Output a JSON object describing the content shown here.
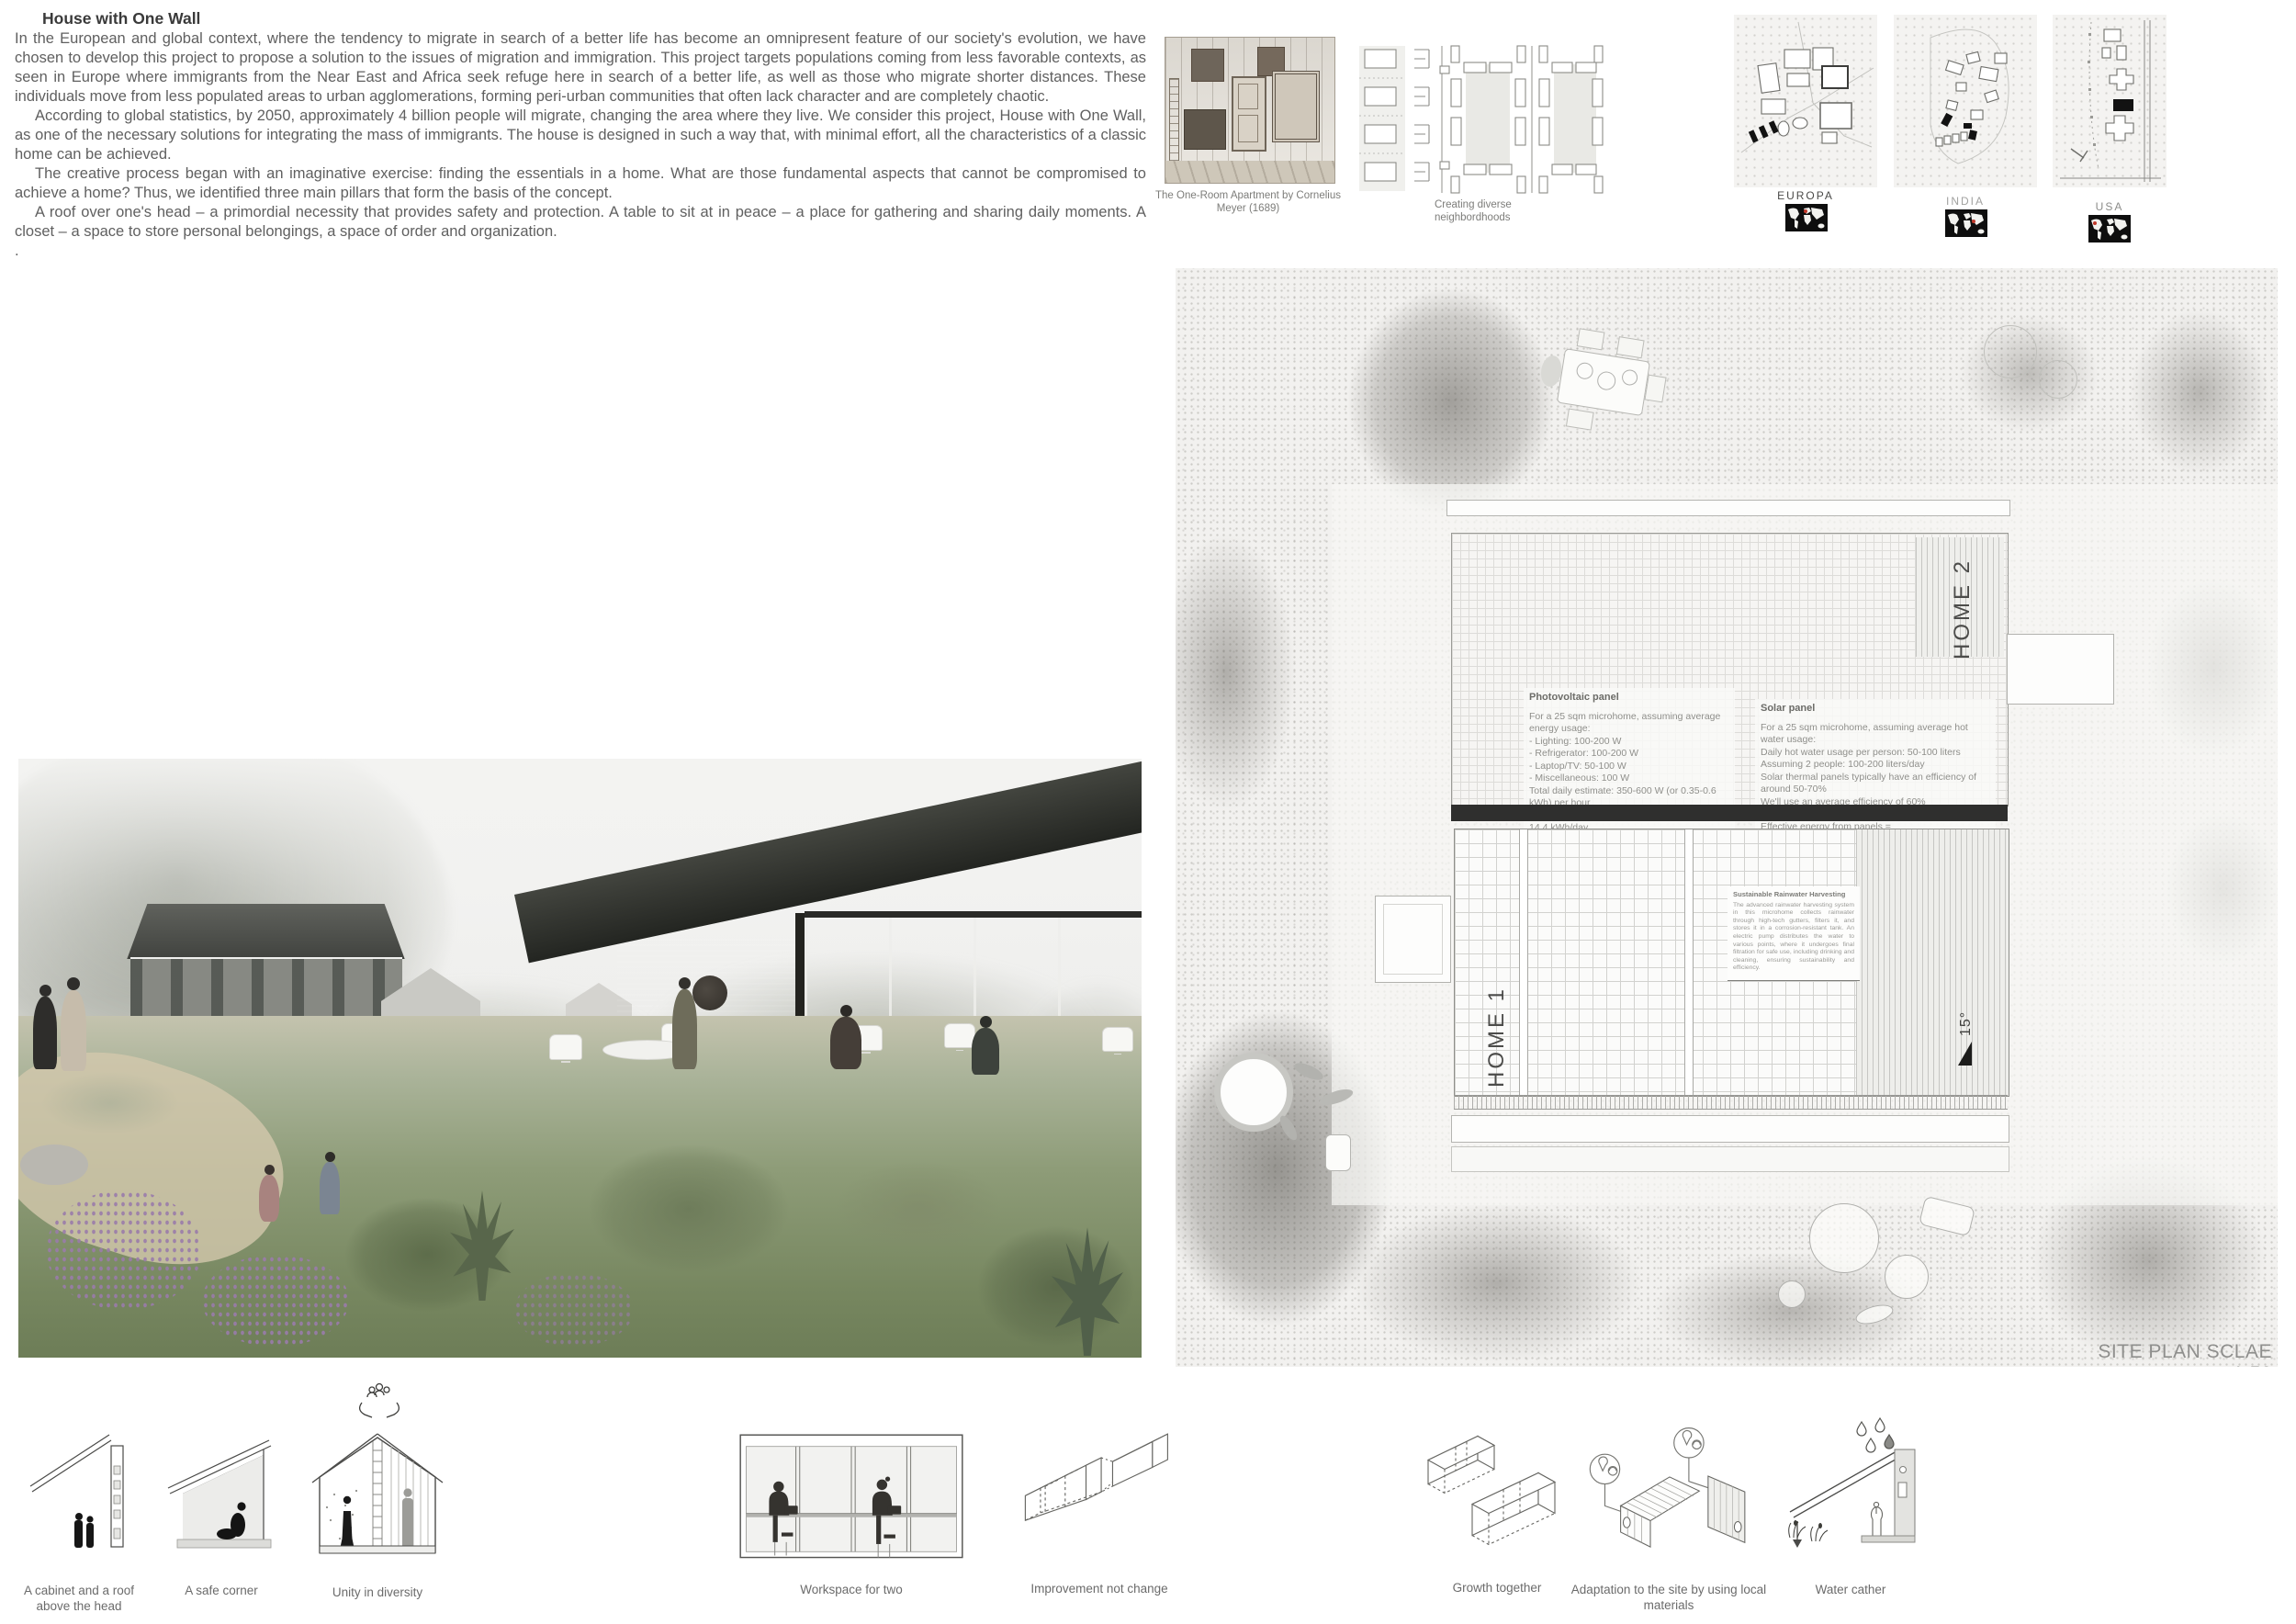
{
  "colors": {
    "map_marker_red": "#c0392b",
    "one_wall_black": "#2f2f2e",
    "text_gray": "#606060"
  },
  "icons": {
    "hands_people": "hands-holding-community",
    "location_material": "map-pin-with-leaf-cycle",
    "rain_drops": "water-droplets",
    "world_map": "black-world-map-with-red-marker"
  },
  "intro": {
    "title": "House with One Wall",
    "p1": "In the European and global context, where the tendency to migrate in search of a better life has become an omnipresent feature of our society's evolution, we have chosen to develop this project to propose a solution to the issues of migration and immigration. This project targets populations coming from less favorable contexts, as seen in Europe where immigrants from the Near East and Africa seek refuge here in search of a better life, as well as those who migrate shorter distances. These individuals move from less populated areas to urban agglomerations, forming peri-urban communities that often lack character and are completely chaotic.",
    "p2": "According to global statistics, by 2050, approximately 4 billion people will migrate, changing the area where they live. We consider this project, House with One Wall, as one of the necessary solutions for integrating the mass of immigrants. The house is designed in such a way that, with minimal effort, all the characteristics of a classic home can be achieved.",
    "p3": "The creative process began with an imaginative exercise: finding the essentials in a home. What are those fundamental aspects that cannot be compromised to achieve a home? Thus, we identified three main pillars that form the basis of the concept.",
    "p4": "A roof over one's head – a primordial necessity that provides safety and protection. A table to sit at in peace – a place for gathering and sharing daily moments. A closet – a space to store personal belongings, a space of order and organization.",
    "dot": "."
  },
  "references": {
    "etching_caption": "The One-Room Apartment by Cornelius Meyer (1689)",
    "neighborhoods_caption": "Creating diverse neighbordhoods"
  },
  "maps": [
    {
      "label": "EUROPA"
    },
    {
      "label": "INDIA"
    },
    {
      "label": "USA"
    }
  ],
  "site_plan": {
    "home1": "HOME 1",
    "home2": "HOME 2",
    "slope": "15°",
    "scale": "SITE PLAN SCLAE 1:50",
    "photovoltaic": {
      "title": "Photovoltaic panel",
      "lines": [
        "For a 25 sqm microhome, assuming average energy usage:",
        "- Lighting: 100-200 W",
        "- Refrigerator: 100-200 W",
        "- Laptop/TV: 50-100 W",
        "- Miscellaneous: 100 W",
        "Total daily estimate: 350-600 W (or 0.35-0.6 kWh) per hour",
        "For a full day: 350-600 W x 24 hours = 8.4 - 14.4 kWh/day",
        "1 sqm of solar panel produces = 0.15 kW x 4 hours = 0.6 kWh/day",
        "8.4 kWh / 0.6 kWh/sqm = 14 sqm"
      ]
    },
    "solar": {
      "title": "Solar panel",
      "lines": [
        "For a 25 sqm microhome, assuming average hot water usage:",
        "Daily hot water usage per person: 50-100 liters",
        "Assuming 2 people: 100-200 liters/day",
        "Solar thermal panels typically have an efficiency of around 50-70%",
        "We'll use an average efficiency of 60%",
        "For 100 liters (4.64 kWh/day):",
        "Effective energy from panels = 4.64/0.6=7.73kWh/day",
        "7.73kWh / 0.6 = 12.88 sqm"
      ]
    },
    "rainwater": {
      "title": "Sustainable Rainwater Harvesting",
      "body": "The advanced rainwater harvesting system in this microhome collects rainwater through high-tech gutters, filters it, and stores it in a corrosion-resistant tank. An electric pump distributes the water to various points, where it undergoes final filtration for safe use, including drinking and cleaning, ensuring sustainability and efficiency."
    }
  },
  "concepts": [
    {
      "caption": "A cabinet and a roof above the head"
    },
    {
      "caption": "A safe corner"
    },
    {
      "caption": "Unity in diversity"
    },
    {
      "caption": "Workspace for two"
    },
    {
      "caption": "Improvement not change"
    },
    {
      "caption": "Growth together"
    },
    {
      "caption": "Adaptation to the site by using local materials"
    },
    {
      "caption": "Water cather"
    }
  ]
}
